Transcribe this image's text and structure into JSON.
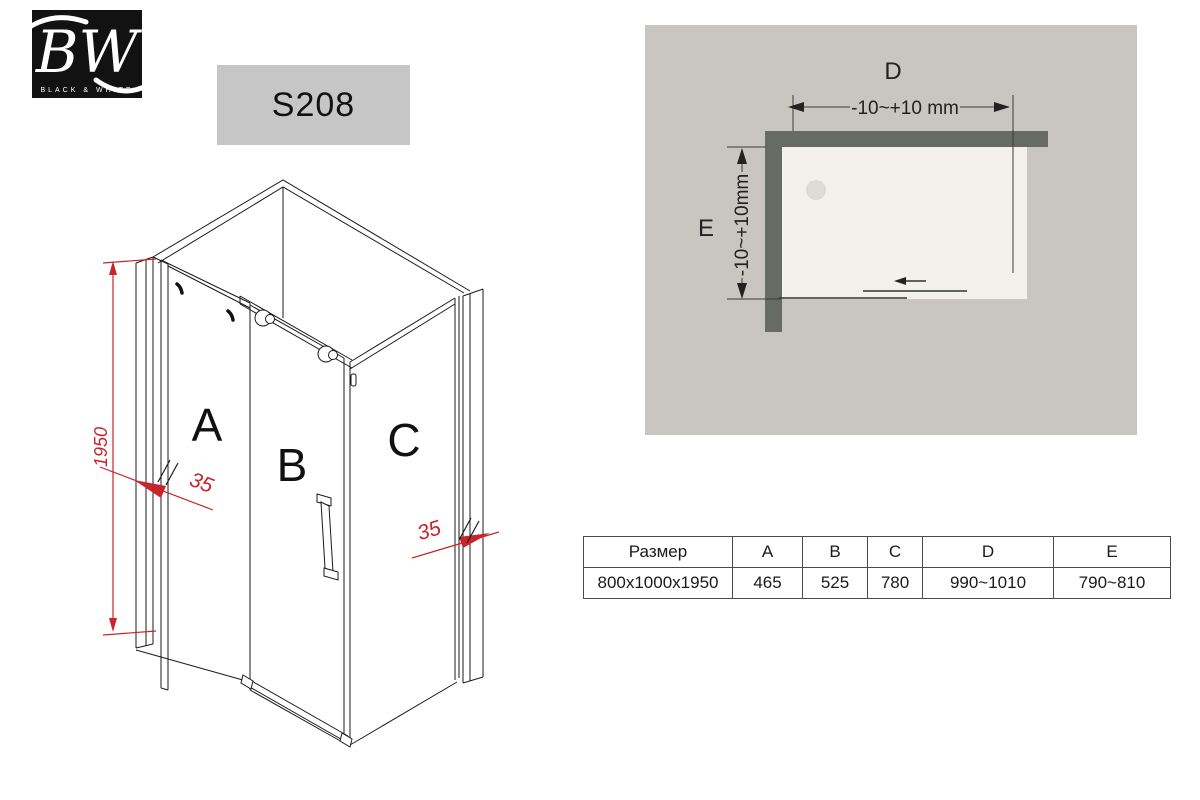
{
  "logo": {
    "monogram": "BW",
    "subtitle": "BLACK & WHITE"
  },
  "model": {
    "code": "S208"
  },
  "iso": {
    "panel_a": "A",
    "panel_b": "B",
    "panel_c": "C",
    "height_dim": "1950",
    "glass_thickness_left": "35",
    "glass_thickness_right": "35"
  },
  "top_view": {
    "width_label": "D",
    "width_tolerance": "-10~+10 mm",
    "depth_label": "E",
    "depth_tolerance": "-10~+10mm"
  },
  "table": {
    "headers": [
      "Размер",
      "A",
      "B",
      "C",
      "D",
      "E"
    ],
    "rows": [
      [
        "800x1000x1950",
        "465",
        "525",
        "780",
        "990~1010",
        "790~810"
      ]
    ]
  },
  "colors": {
    "accent_red": "#c8242b",
    "wall_gray": "#676b62",
    "panel_background": "#c9c6c2",
    "tray": "#f2f1ec",
    "model_badge": "#c6c6c6",
    "logo_black": "#121212"
  }
}
